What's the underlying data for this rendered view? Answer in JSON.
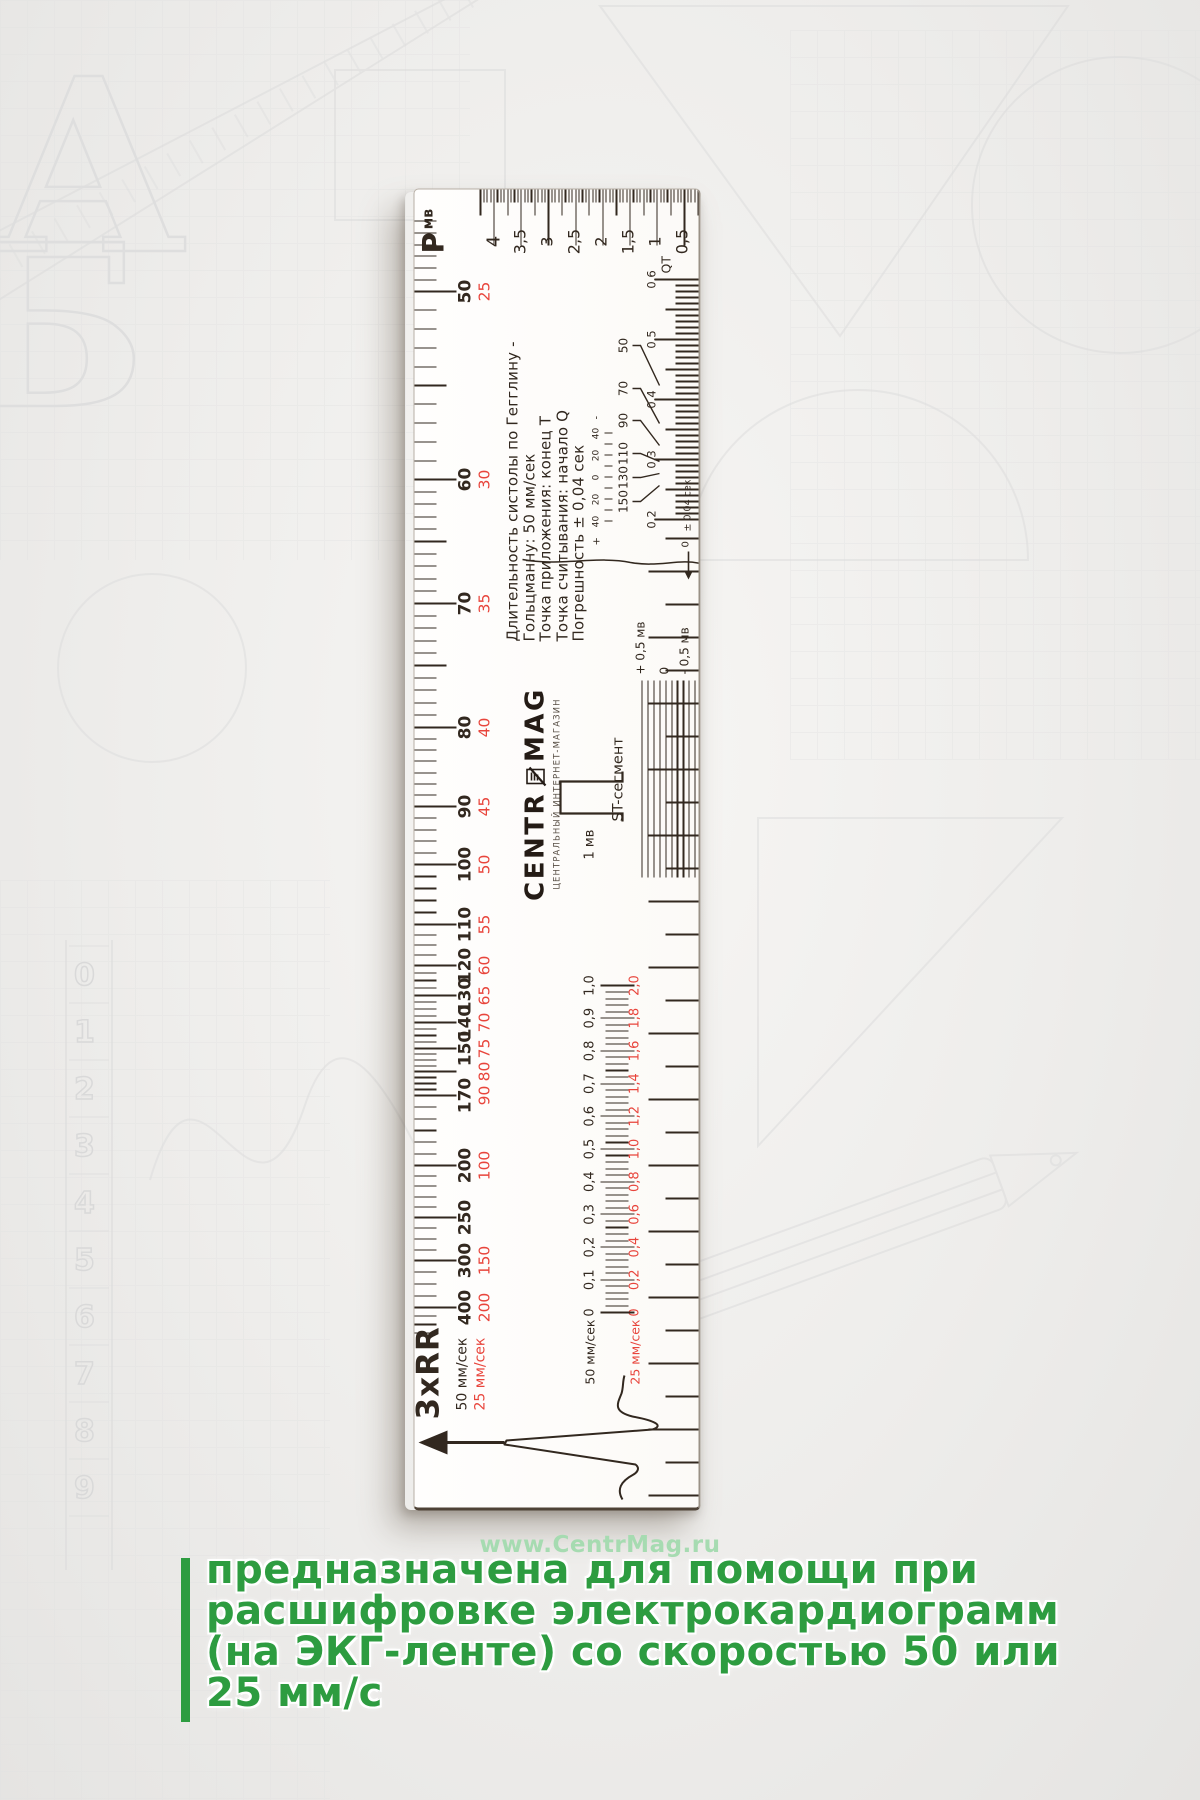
{
  "page": {
    "url": "www.CentrMag.ru",
    "headline": [
      "предназначена для помощи при",
      "расшифровке электрокардиограмм",
      "(на ЭКГ-ленте) со скоростью 50 или",
      "25 мм/с"
    ],
    "headline_color": "#2d9c40",
    "url_color": "#a6dbb1"
  },
  "ruler": {
    "ink": "#32281f",
    "red": "#e8453c",
    "rr": {
      "title": "3xRR",
      "speed50": "50 мм/сек",
      "speed25": "25 мм/сек",
      "labels": [
        {
          "hr": "400",
          "half": "200",
          "x": 200
        },
        {
          "hr": "300",
          "half": "150",
          "x": 247
        },
        {
          "hr": "250",
          "half": "",
          "x": 290
        },
        {
          "hr": "200",
          "half": "100",
          "x": 342
        },
        {
          "hr": "170",
          "half": "90",
          "x": 412
        },
        {
          "hr": "",
          "half": "80",
          "x": 436
        },
        {
          "hr": "150",
          "half": "75",
          "x": 459
        },
        {
          "hr": "140",
          "half": "70",
          "x": 485
        },
        {
          "hr": "130",
          "half": "65",
          "x": 512
        },
        {
          "hr": "120",
          "half": "60",
          "x": 542
        },
        {
          "hr": "110",
          "half": "55",
          "x": 583
        },
        {
          "hr": "100",
          "half": "50",
          "x": 643
        },
        {
          "hr": "90",
          "half": "45",
          "x": 701
        },
        {
          "hr": "80",
          "half": "40",
          "x": 780
        },
        {
          "hr": "70",
          "half": "35",
          "x": 904
        },
        {
          "hr": "60",
          "half": "30",
          "x": 1028
        },
        {
          "hr": "50",
          "half": "25",
          "x": 1216
        }
      ]
    },
    "p": {
      "letter": "Р",
      "unit": "мв",
      "labels": [
        {
          "v": "4",
          "y": 79
        },
        {
          "v": "3,5",
          "y": 106
        },
        {
          "v": "3",
          "y": 133
        },
        {
          "v": "2,5",
          "y": 160
        },
        {
          "v": "2",
          "y": 187
        },
        {
          "v": "1,5",
          "y": 214
        },
        {
          "v": "1",
          "y": 241
        },
        {
          "v": "0,5",
          "y": 268
        }
      ]
    },
    "info_lines": [
      "Длительность систолы по Гегглину -",
      "Гольцманну: 50 мм/сек",
      "Точка приложения: конец Т",
      "Точка считывания: начало Q",
      "Погрешность ± 0,04 сек"
    ],
    "qt": {
      "unit": "QT",
      "tolerance": "± 0,04 сек",
      "zero": "0",
      "plus": "+",
      "minus": "-",
      "tol_marks": [
        "40",
        "20",
        "0",
        "20",
        "40"
      ],
      "rates": [
        {
          "v": "50",
          "x": 1162,
          "tx": 1122
        },
        {
          "v": "70",
          "x": 1119,
          "tx": 1084
        },
        {
          "v": "90",
          "x": 1087,
          "tx": 1062
        },
        {
          "v": "110",
          "x": 1054,
          "tx": 1046
        },
        {
          "v": "130",
          "x": 1030,
          "tx": 1034
        },
        {
          "v": "150",
          "x": 1006,
          "tx": 1022
        }
      ],
      "labels": [
        {
          "v": "0,2",
          "x": 988
        },
        {
          "v": "0,3",
          "x": 1048
        },
        {
          "v": "0,4",
          "x": 1108
        },
        {
          "v": "0,5",
          "x": 1168
        },
        {
          "v": "0,6",
          "x": 1228
        }
      ]
    },
    "logo": {
      "left": "CENTR",
      "right": "MAG",
      "sub": "ЦЕНТРАЛЬНЫЙ ИНТЕРНЕТ-МАГАЗИН"
    },
    "st": {
      "label": "ST-сегмент",
      "top": "+ 0,5 мв",
      "mid": "0",
      "bottom": "- 0,5 мв"
    },
    "mv": {
      "label": "1 мв"
    },
    "time": {
      "label50": "50 мм/сек",
      "label25": "25 мм/сек",
      "black": [
        "0",
        "0,1",
        "0,2",
        "0,3",
        "0,4",
        "0,5",
        "0,6",
        "0,7",
        "0,8",
        "0,9",
        "1,0"
      ],
      "red": [
        "0",
        "0,2",
        "0,4",
        "0,6",
        "0,8",
        "1,0",
        "1,2",
        "1,4",
        "1,6",
        "1,8",
        "2,0"
      ]
    }
  },
  "background": {
    "letters": [
      "А",
      "Б"
    ],
    "digits": [
      "0",
      "1",
      "2",
      "3",
      "4",
      "5",
      "6",
      "7",
      "8",
      "9"
    ]
  }
}
